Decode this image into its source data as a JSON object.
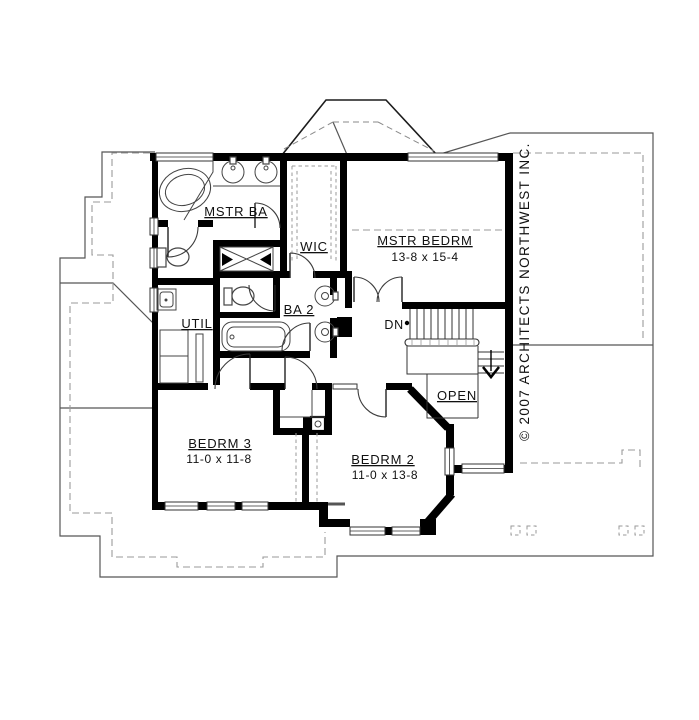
{
  "rooms": {
    "mstr_ba": {
      "label": "MSTR BA"
    },
    "wic": {
      "label": "WIC"
    },
    "mstr_bedrm": {
      "label": "MSTR BEDRM",
      "dims": "13-8 x 15-4"
    },
    "util": {
      "label": "UTIL"
    },
    "ba_2": {
      "label": "BA 2"
    },
    "bedrm_3": {
      "label": "BEDRM 3",
      "dims": "11-0 x 11-8"
    },
    "bedrm_2": {
      "label": "BEDRM 2",
      "dims": "11-0 x 13-8"
    },
    "open_area": {
      "label": "OPEN"
    }
  },
  "stairs": {
    "direction_label": "DN"
  },
  "copyright": {
    "text": "© 2007 ARCHITECTS NORTHWEST INC."
  },
  "colors": {
    "walls": "#000000",
    "lines": "#3c3c3c",
    "dashed": "#9a9a9a",
    "paper": "#ffffff"
  }
}
